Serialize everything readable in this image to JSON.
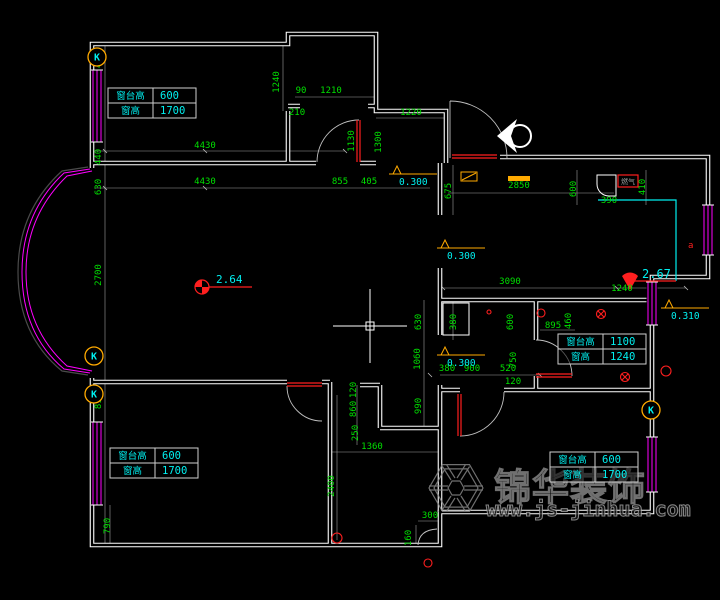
{
  "colors": {
    "wall": "#ffffff",
    "dim_text": "#00e000",
    "dim_line": "#c8c8c8",
    "cyan": "#00f0f0",
    "magenta": "#ff00ff",
    "orange": "#ffaa00",
    "red": "#ff1f1f",
    "watermark": "#8c8c8c",
    "bg": "#000000"
  },
  "watermark": {
    "brand": "锦华装饰",
    "url": "www.js-jinhua.com"
  },
  "spots": [
    {
      "text": "2.64",
      "x": 216,
      "y": 283
    },
    {
      "text": "2.67",
      "x": 642,
      "y": 278
    }
  ],
  "gas_meter": {
    "label": "燃气"
  },
  "socket_letter": {
    "text": "a",
    "x": 688,
    "y": 248
  },
  "k_marker_label": "K",
  "k_markers": [
    {
      "x": 97,
      "y": 57
    },
    {
      "x": 94,
      "y": 356
    },
    {
      "x": 94,
      "y": 394
    },
    {
      "x": 651,
      "y": 410
    }
  ],
  "levels": [
    {
      "text": "0.300",
      "x": 393,
      "y": 166
    },
    {
      "text": "0.300",
      "x": 441,
      "y": 240
    },
    {
      "text": "0.300",
      "x": 441,
      "y": 347
    },
    {
      "text": "0.310",
      "x": 665,
      "y": 300
    }
  ],
  "window_tables": [
    {
      "x": 108,
      "y": 88,
      "rows": [
        {
          "label": "窗台高",
          "value": "600"
        },
        {
          "label": "窗高",
          "value": "1700"
        }
      ]
    },
    {
      "x": 558,
      "y": 334,
      "rows": [
        {
          "label": "窗台高",
          "value": "1100"
        },
        {
          "label": "窗高",
          "value": "1240"
        }
      ]
    },
    {
      "x": 550,
      "y": 452,
      "rows": [
        {
          "label": "窗台高",
          "value": "600"
        },
        {
          "label": "窗高",
          "value": "1700"
        }
      ]
    },
    {
      "x": 110,
      "y": 448,
      "rows": [
        {
          "label": "窗台高",
          "value": "600"
        },
        {
          "label": "窗高",
          "value": "1700"
        }
      ]
    }
  ],
  "dimensions": [
    {
      "t": "450",
      "x": 101,
      "y": 60,
      "v": 1
    },
    {
      "t": "440",
      "x": 101,
      "y": 157,
      "v": 1
    },
    {
      "t": "630",
      "x": 101,
      "y": 187,
      "v": 1
    },
    {
      "t": "2700",
      "x": 101,
      "y": 275,
      "v": 1
    },
    {
      "t": "630",
      "x": 101,
      "y": 356,
      "v": 1
    },
    {
      "t": "815",
      "x": 101,
      "y": 401,
      "v": 1
    },
    {
      "t": "790",
      "x": 110,
      "y": 526,
      "v": 1
    },
    {
      "t": "1240",
      "x": 279,
      "y": 82,
      "v": 1
    },
    {
      "t": "90",
      "x": 301,
      "y": 93,
      "v": 0
    },
    {
      "t": "1210",
      "x": 331,
      "y": 93,
      "v": 0
    },
    {
      "t": "210",
      "x": 297,
      "y": 115,
      "v": 0
    },
    {
      "t": "4430",
      "x": 205,
      "y": 148,
      "v": 0
    },
    {
      "t": "4430",
      "x": 205,
      "y": 184,
      "v": 0
    },
    {
      "t": "855",
      "x": 340,
      "y": 184,
      "v": 0
    },
    {
      "t": "405",
      "x": 369,
      "y": 184,
      "v": 0
    },
    {
      "t": "1130",
      "x": 354,
      "y": 141,
      "v": 1
    },
    {
      "t": "1300",
      "x": 381,
      "y": 142,
      "v": 1
    },
    {
      "t": "1220",
      "x": 411,
      "y": 115,
      "v": 0
    },
    {
      "t": "675",
      "x": 451,
      "y": 191,
      "v": 1
    },
    {
      "t": "2850",
      "x": 519,
      "y": 188,
      "v": 0
    },
    {
      "t": "600",
      "x": 576,
      "y": 189,
      "v": 1
    },
    {
      "t": "410",
      "x": 645,
      "y": 187,
      "v": 1
    },
    {
      "t": "390",
      "x": 609,
      "y": 203,
      "v": 0
    },
    {
      "t": "3090",
      "x": 510,
      "y": 284,
      "v": 0
    },
    {
      "t": "1240",
      "x": 622,
      "y": 291,
      "v": 0
    },
    {
      "t": "630",
      "x": 421,
      "y": 322,
      "v": 1
    },
    {
      "t": "1060",
      "x": 420,
      "y": 359,
      "v": 1
    },
    {
      "t": "990",
      "x": 421,
      "y": 406,
      "v": 1
    },
    {
      "t": "380",
      "x": 456,
      "y": 322,
      "v": 1
    },
    {
      "t": "600",
      "x": 513,
      "y": 322,
      "v": 1
    },
    {
      "t": "460",
      "x": 571,
      "y": 321,
      "v": 1
    },
    {
      "t": "750",
      "x": 516,
      "y": 360,
      "v": 1
    },
    {
      "t": "895",
      "x": 553,
      "y": 328,
      "v": 0
    },
    {
      "t": "380",
      "x": 447,
      "y": 371,
      "v": 0
    },
    {
      "t": "900",
      "x": 472,
      "y": 371,
      "v": 0
    },
    {
      "t": "520",
      "x": 508,
      "y": 371,
      "v": 0
    },
    {
      "t": "120",
      "x": 513,
      "y": 384,
      "v": 0
    },
    {
      "t": "120",
      "x": 356,
      "y": 390,
      "v": 1
    },
    {
      "t": "860",
      "x": 356,
      "y": 409,
      "v": 1
    },
    {
      "t": "250",
      "x": 358,
      "y": 433,
      "v": 1
    },
    {
      "t": "1360",
      "x": 372,
      "y": 449,
      "v": 0
    },
    {
      "t": "2400",
      "x": 334,
      "y": 486,
      "v": 1
    },
    {
      "t": "300",
      "x": 430,
      "y": 518,
      "v": 0
    },
    {
      "t": "160",
      "x": 411,
      "y": 538,
      "v": 1
    }
  ]
}
